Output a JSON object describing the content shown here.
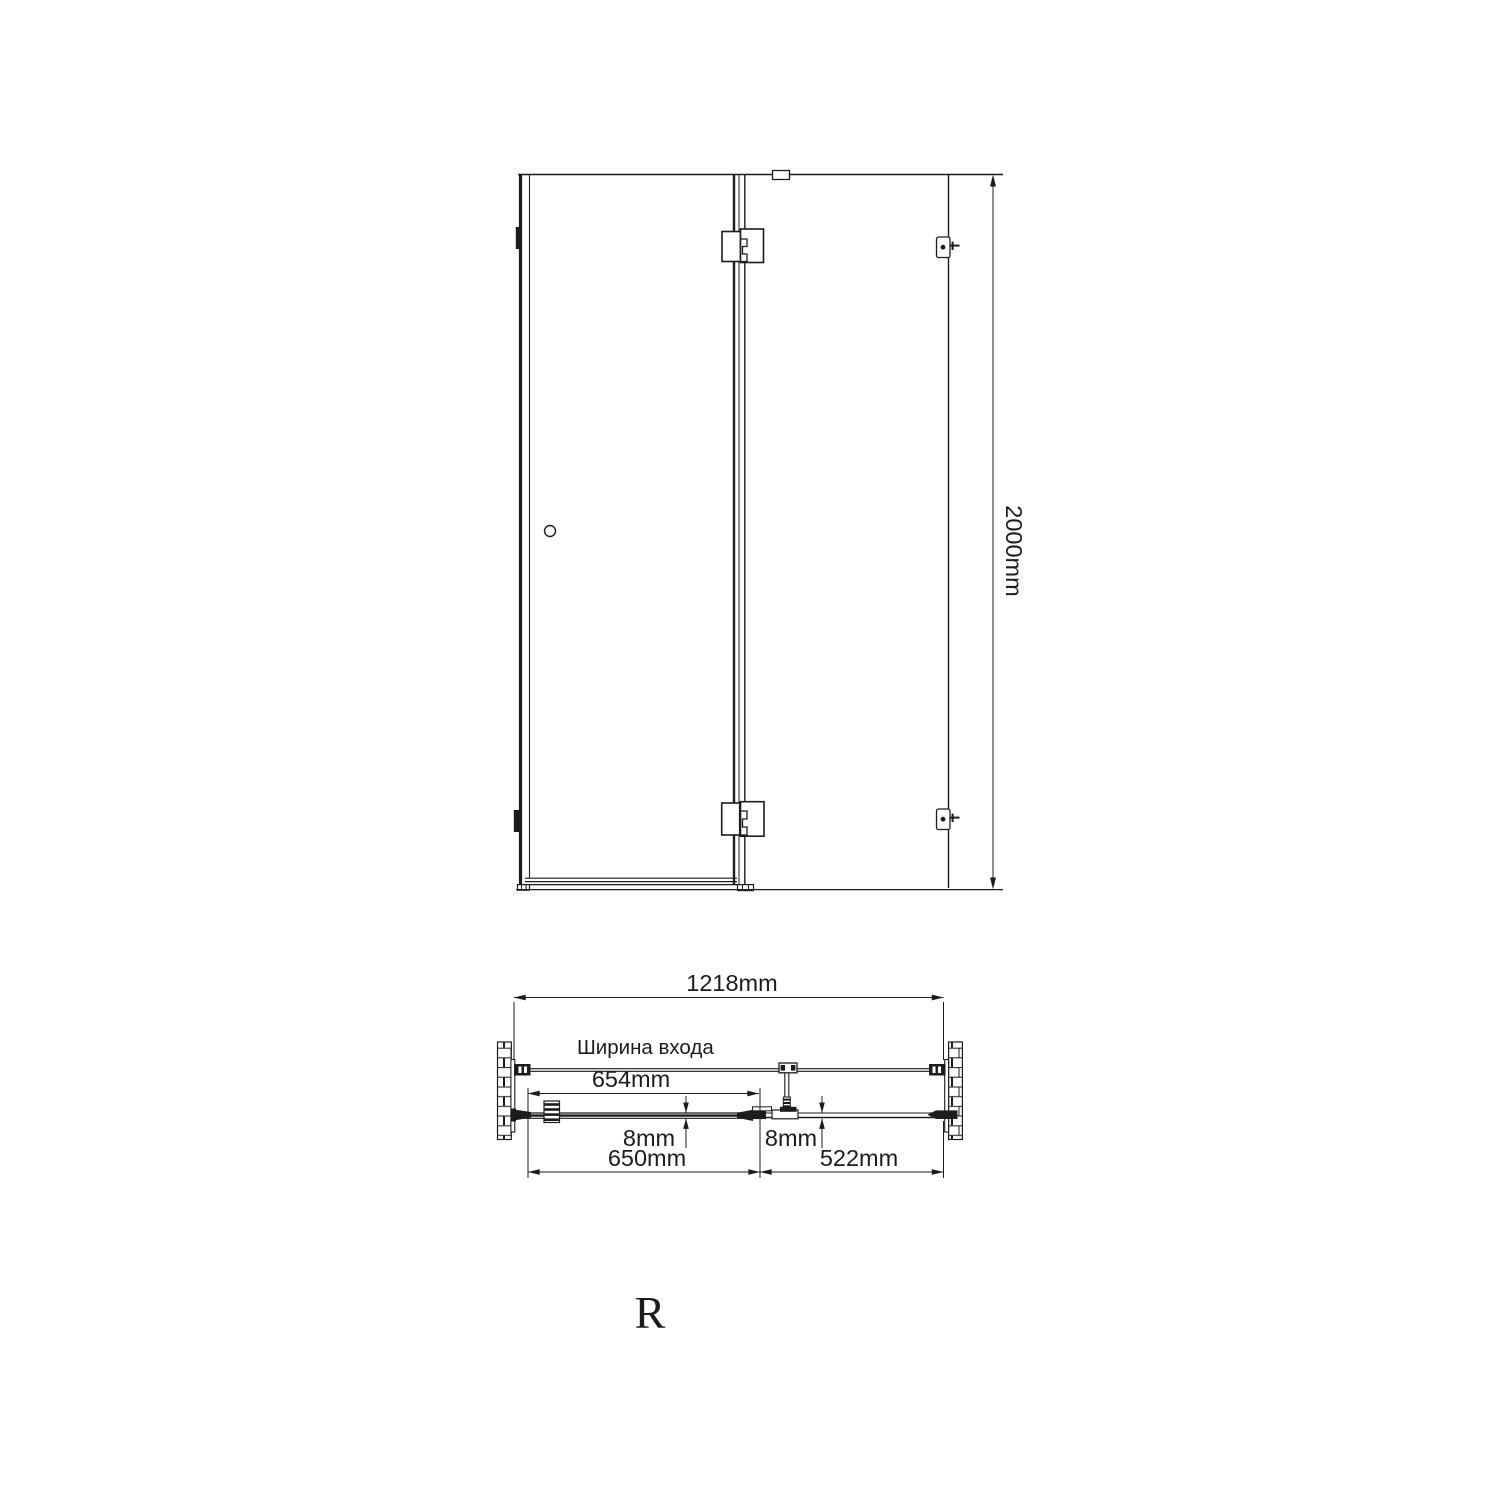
{
  "page": {
    "background": "#ffffff",
    "line_color": "#1c1c1c"
  },
  "front_view": {
    "height_label": "2000mm"
  },
  "plan_view": {
    "overall_width_label": "1218mm",
    "entrance_caption": "Ширина входа",
    "entrance_width_label": "654mm",
    "door_glass_thickness_label": "8mm",
    "fixed_glass_thickness_label": "8mm",
    "door_width_label": "650mm",
    "fixed_panel_width_label": "522mm"
  },
  "orientation": {
    "letter": "R"
  }
}
